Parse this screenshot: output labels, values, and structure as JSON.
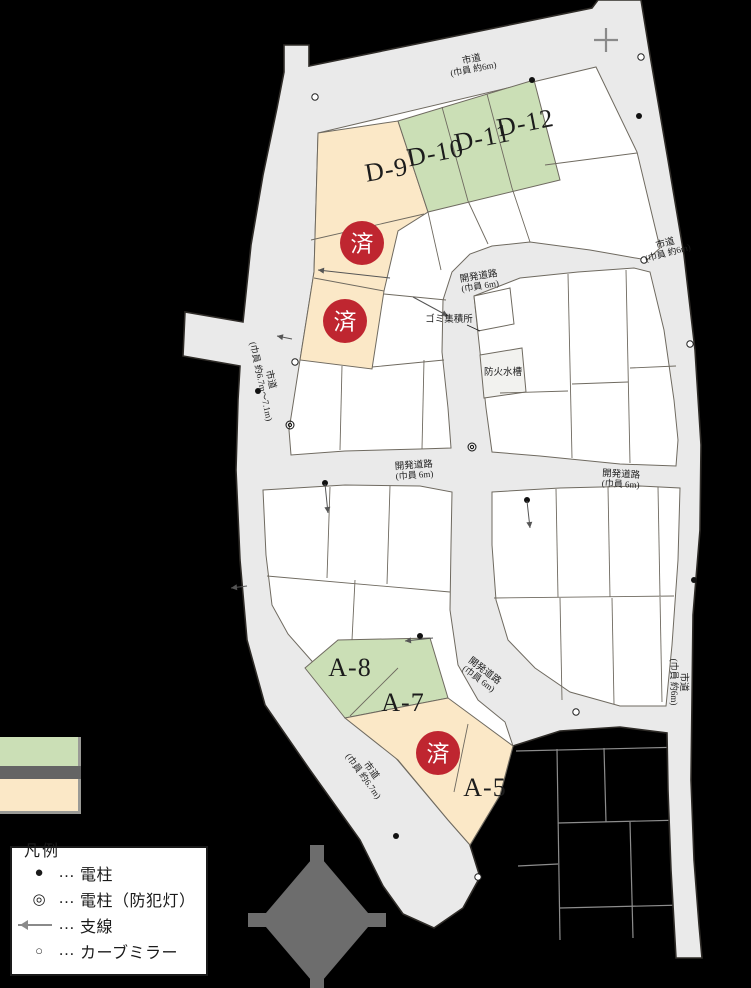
{
  "colors": {
    "road": "#eaeaea",
    "road_outline": "#2f2c28",
    "lot_white": "#ffffff",
    "lot_line": "#6f6a60",
    "lot_green": "#cbdfb6",
    "lot_cream": "#fbe8c7",
    "special_lot": "#f2f2ef",
    "sold_red": "#bf2630",
    "sold_text": "#ffffff",
    "label_text": "#1c1c1c",
    "swatch_dark": "#646464",
    "outside_line": "#8d8d8d",
    "compass_gray": "#6d6d6d",
    "symbol_gray": "#8a8a8a"
  },
  "lot_labels": [
    {
      "label": "D-9",
      "x": 388,
      "y": 178,
      "rot": -10,
      "size": 26
    },
    {
      "label": "D-10",
      "x": 437,
      "y": 161,
      "rot": -11,
      "size": 26
    },
    {
      "label": "D-11",
      "x": 484,
      "y": 146,
      "rot": -11,
      "size": 26
    },
    {
      "label": "D-12",
      "x": 527,
      "y": 131,
      "rot": -11,
      "size": 26
    },
    {
      "label": "A-8",
      "x": 350,
      "y": 676,
      "rot": 0,
      "size": 26
    },
    {
      "label": "A-7",
      "x": 403,
      "y": 711,
      "rot": 0,
      "size": 26
    },
    {
      "label": "A-5",
      "x": 485,
      "y": 796,
      "rot": 0,
      "size": 26
    }
  ],
  "sold_markers": {
    "label": "済",
    "positions": [
      {
        "x": 362,
        "y": 243
      },
      {
        "x": 345,
        "y": 321
      },
      {
        "x": 438,
        "y": 753
      }
    ]
  },
  "road_labels": [
    {
      "line1": "市道",
      "line2": "(巾員 約6m)",
      "x": 472,
      "y": 62,
      "rot": -11
    },
    {
      "line1": "市道",
      "line2": "(巾員 約6m)",
      "x": 666,
      "y": 246,
      "rot": -15
    },
    {
      "line1": "市道",
      "line2": "(巾員 約6m)",
      "x": 681,
      "y": 682,
      "rot": 90
    },
    {
      "line1": "市道",
      "line2": "(巾員 約6.7m〜7.1m)",
      "x": 268,
      "y": 380,
      "rot": 78
    },
    {
      "line1": "市道",
      "line2": "(巾員 約6.7m)",
      "x": 369,
      "y": 772,
      "rot": 54
    },
    {
      "line1": "開発道路",
      "line2": "(巾員 6m)",
      "x": 479,
      "y": 279,
      "rot": -9
    },
    {
      "line1": "開発道路",
      "line2": "(巾員 6m)",
      "x": 414,
      "y": 468,
      "rot": -4
    },
    {
      "line1": "開発道路",
      "line2": "(巾員 6m)",
      "x": 621,
      "y": 477,
      "rot": 3
    },
    {
      "line1": "開発道路",
      "line2": "(巾員 6m)",
      "x": 483,
      "y": 673,
      "rot": 37
    }
  ],
  "facility_labels": [
    {
      "text": "ゴミ集積所",
      "x": 449,
      "y": 322
    },
    {
      "text": "防火水槽",
      "x": 503,
      "y": 375
    }
  ],
  "map_symbols": [
    {
      "type": "utility-pole",
      "x": 532,
      "y": 80
    },
    {
      "type": "utility-pole",
      "x": 639,
      "y": 116
    },
    {
      "type": "utility-pole",
      "x": 258,
      "y": 391
    },
    {
      "type": "utility-pole",
      "x": 325,
      "y": 483
    },
    {
      "type": "utility-pole",
      "x": 527,
      "y": 500
    },
    {
      "type": "utility-pole",
      "x": 694,
      "y": 580
    },
    {
      "type": "utility-pole",
      "x": 420,
      "y": 636
    },
    {
      "type": "utility-pole",
      "x": 396,
      "y": 836
    },
    {
      "type": "utility-pole-light",
      "x": 290,
      "y": 425
    },
    {
      "type": "utility-pole-light",
      "x": 472,
      "y": 447
    },
    {
      "type": "curve-mirror",
      "x": 315,
      "y": 97
    },
    {
      "type": "curve-mirror",
      "x": 641,
      "y": 57
    },
    {
      "type": "curve-mirror",
      "x": 644,
      "y": 260
    },
    {
      "type": "curve-mirror",
      "x": 690,
      "y": 344
    },
    {
      "type": "curve-mirror",
      "x": 295,
      "y": 362
    },
    {
      "type": "curve-mirror",
      "x": 576,
      "y": 712
    },
    {
      "type": "curve-mirror",
      "x": 478,
      "y": 877
    },
    {
      "type": "guy-wire",
      "x": 390,
      "y": 278,
      "x2": 318,
      "y2": 270
    },
    {
      "type": "guy-wire",
      "x": 413,
      "y": 297,
      "x2": 448,
      "y2": 316
    },
    {
      "type": "guy-wire",
      "x": 325,
      "y": 484,
      "x2": 328,
      "y2": 513
    },
    {
      "type": "guy-wire",
      "x": 527,
      "y": 501,
      "x2": 530,
      "y2": 528
    },
    {
      "type": "guy-wire",
      "x": 433,
      "y": 638,
      "x2": 405,
      "y2": 641
    },
    {
      "type": "guy-wire",
      "x": 247,
      "y": 586,
      "x2": 231,
      "y2": 588
    },
    {
      "type": "guy-wire",
      "x": 292,
      "y": 339,
      "x2": 277,
      "y2": 336
    }
  ],
  "legend": {
    "title": "凡例",
    "dots": "…",
    "items": [
      {
        "symbol": "utility-pole-icon",
        "label": "電柱"
      },
      {
        "symbol": "utility-pole-light-icon",
        "label": "電柱（防犯灯）"
      },
      {
        "symbol": "guy-wire-icon",
        "label": "支線"
      },
      {
        "symbol": "curve-mirror-icon",
        "label": "カーブミラー"
      }
    ]
  },
  "swatches": [
    {
      "name": "lot-green-swatch",
      "color": "#cbdfb6"
    },
    {
      "name": "divider-dark-swatch",
      "color": "#646464"
    },
    {
      "name": "lot-cream-swatch",
      "color": "#fbe8c7"
    }
  ]
}
